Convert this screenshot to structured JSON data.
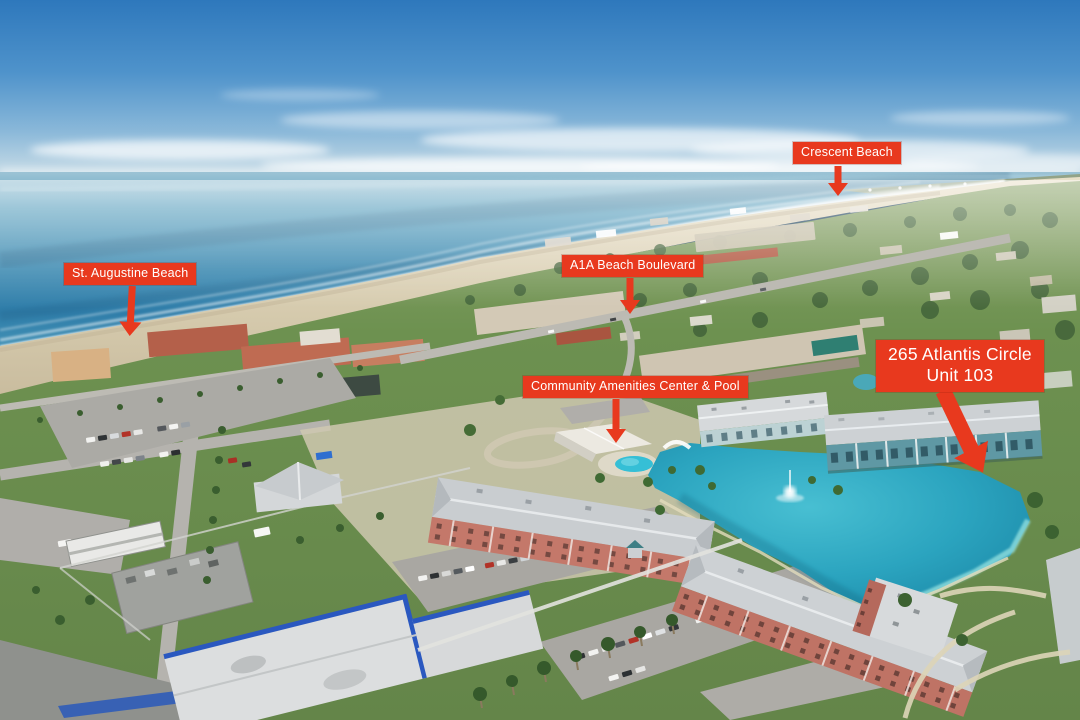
{
  "annotations": {
    "crescent_beach": "Crescent Beach",
    "st_augustine_beach": "St. Augustine Beach",
    "a1a_beach_boulevard": "A1A Beach Boulevard",
    "community_amenities": "Community Amenities Center & Pool",
    "property_line1": "265 Atlantis Circle",
    "property_line2": "Unit 103"
  },
  "colors": {
    "annotation_bg": "#e8391e",
    "annotation_text": "#ffffff",
    "sky": "#3d85c4",
    "ocean": "#3a88b0",
    "sand": "#d8cdb0",
    "lawn": "#6d9150",
    "lake": "#2ba4bf",
    "pool": "#35bfd6",
    "condo_walls": "#c4786a",
    "target_building": "#629aa6"
  }
}
